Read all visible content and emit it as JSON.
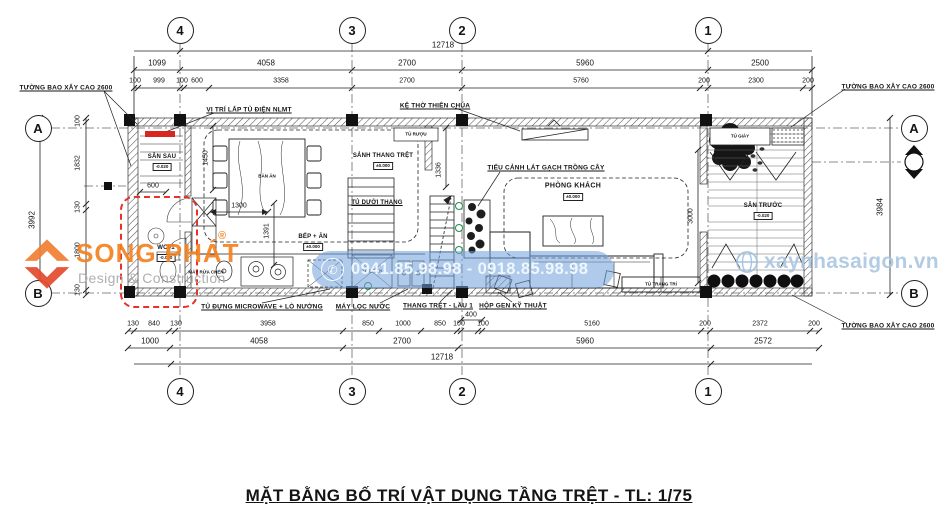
{
  "title": "MẶT BẰNG BỐ TRÍ VẬT DỤNG TẦNG TRỆT - TL: 1/75",
  "grid": {
    "cols": [
      "4",
      "3",
      "2",
      "1"
    ],
    "rows": [
      "A",
      "B"
    ]
  },
  "annotations": {
    "wall_top_left": "TƯỜNG BAO XÂY CAO 2600",
    "wall_top_right": "TƯỜNG BAO XÂY CAO 2600",
    "wall_bottom_right": "TƯỜNG BAO XÂY CAO 2600",
    "solar_cabinet": "VỊ TRÍ LẮP TỦ ĐIỆN NLMT",
    "altar_shelf": "KỆ THỜ THIÊN CHÚA",
    "planter_note": "TIỂU CẢNH LÁT GẠCH TRỒNG CÂY",
    "microwave_cabinet": "TỦ ĐỰNG MICROWAVE + LÒ NƯỚNG",
    "water_filter": "MÁY LỌC NƯỚC",
    "stair_note": "THANG TRỆT - LẦU 1",
    "duct_box": "HỘP GEN KỸ THUẬT"
  },
  "rooms": {
    "san_sau": {
      "name": "SÂN SAU",
      "elev": "-0.020"
    },
    "wc": {
      "name": "WC01",
      "elev": "-0.020"
    },
    "dining_table": "BÀN ĂN",
    "stair_lobby": {
      "name": "SẢNH THANG TRỆT",
      "elev": "±0.000"
    },
    "wine_cabinet": "TỦ RƯỢU",
    "under_stair_cabinet": "TỦ DƯỚI THANG",
    "kitchen": {
      "name": "BẾP + ĂN",
      "elev": "±0.000"
    },
    "fridge": "TỦ LẠNH",
    "dishwasher": "MÁY RỬA CHÉN",
    "living": {
      "name": "PHÒNG KHÁCH",
      "elev": "±0.000"
    },
    "deco_cabinet": "TỦ TRANG TRÍ",
    "shoe_cabinet": "TỦ GIÀY",
    "san_truoc": {
      "name": "SÂN TRƯỚC",
      "elev": "-0.020"
    }
  },
  "dims": {
    "top_total": "12718",
    "top1": [
      "1099",
      "4058",
      "2700",
      "5960",
      "2500"
    ],
    "top2": [
      "100",
      "999",
      "100",
      "600",
      "3358",
      "2700",
      "5760",
      "200",
      "2300",
      "200"
    ],
    "left": [
      "100",
      "1832",
      "130",
      "1800",
      "130"
    ],
    "left_total": "3992",
    "right_total": "3984",
    "inner": {
      "w1450": "1450",
      "w600": "600",
      "w1336": "1336",
      "w1300": "1300",
      "w1391": "1391",
      "w3000": "3000"
    },
    "bot1": [
      "130",
      "840",
      "130",
      "3958",
      "850",
      "1000",
      "850",
      "100",
      "400",
      "100",
      "5160",
      "200",
      "2372",
      "200"
    ],
    "bot2": [
      "1000",
      "4058",
      "2700",
      "5960",
      "2572"
    ],
    "bot_total": "12718"
  },
  "watermarks": {
    "brand": "SONG PHÁT",
    "brand_sub": "Design & Construction",
    "reg": "®",
    "phone_icon": "✆",
    "phone": "0941.85.98.98 - 0918.85.98.98",
    "site": "xaynhasaigon.vn"
  },
  "colors": {
    "accent_red": "#e63228",
    "brand_orange": "#f5821f",
    "wm_blue": "#a9c6e0"
  }
}
